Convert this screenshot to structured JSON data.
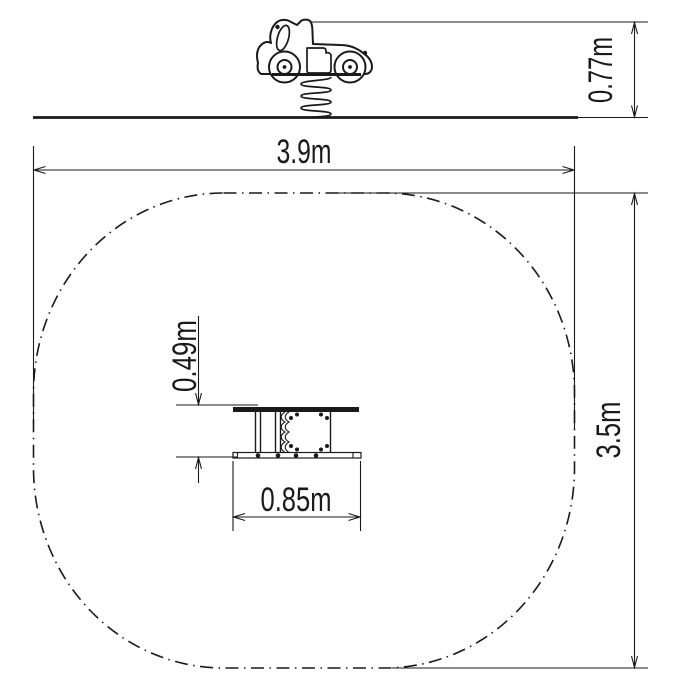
{
  "diagram": {
    "kind": "spring rider installation drawing",
    "background": "#ffffff",
    "ink": "#1a1a1a"
  },
  "side_view": {
    "equipment": "car spring rider side elevation",
    "height": {
      "label": "0.77m",
      "value": 0.77,
      "unit": "m"
    }
  },
  "plan_view": {
    "safety_zone": {
      "width": {
        "label": "3.9m",
        "value": 3.9,
        "unit": "m"
      },
      "depth": {
        "label": "3.5m",
        "value": 3.5,
        "unit": "m"
      }
    },
    "equipment_footprint": {
      "width": {
        "label": "0.85m",
        "value": 0.85,
        "unit": "m"
      },
      "depth": {
        "label": "0.49m",
        "value": 0.49,
        "unit": "m"
      }
    }
  }
}
